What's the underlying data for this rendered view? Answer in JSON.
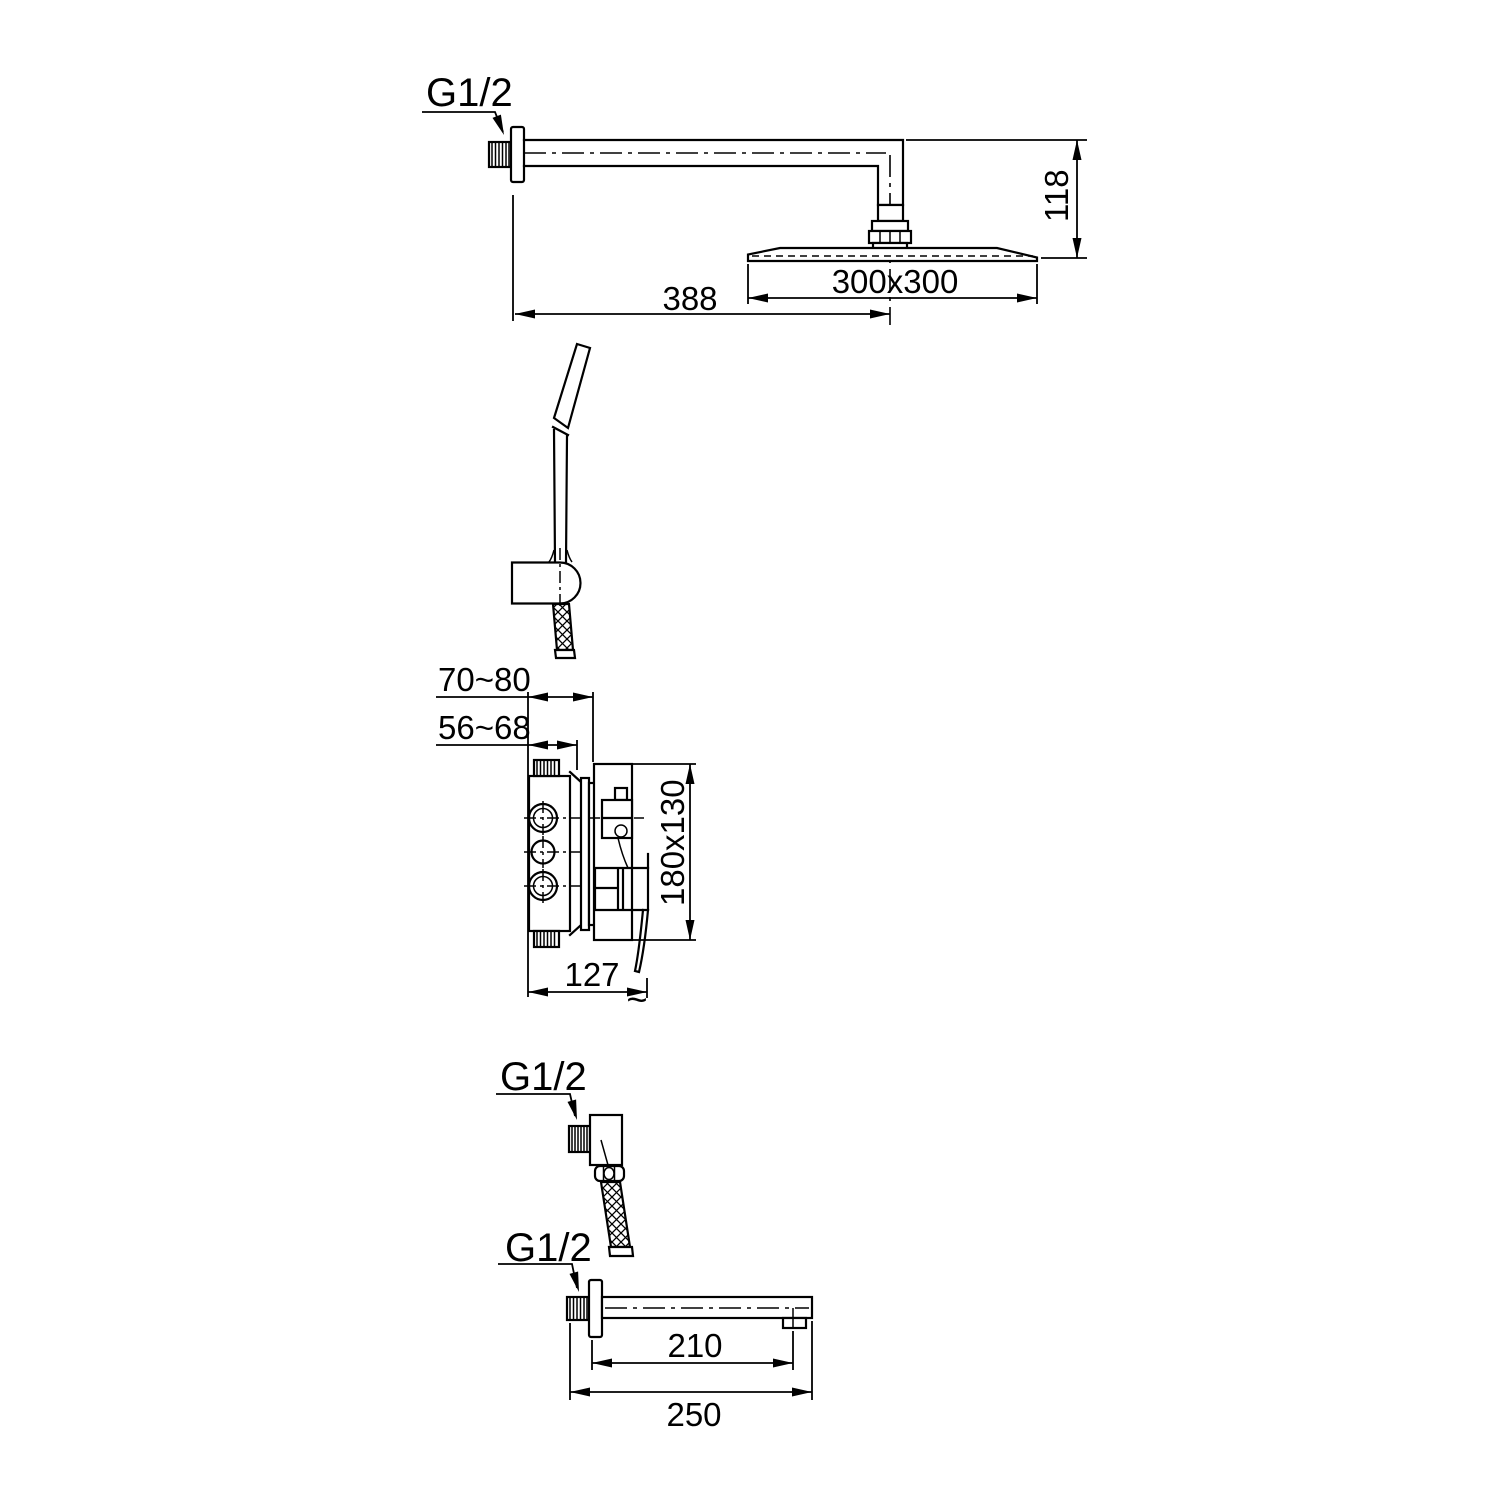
{
  "drawing": {
    "background_color": "#ffffff",
    "line_color": "#000000",
    "rain_shower": {
      "thread_label": "G1/2",
      "drop_height": "118",
      "head_size": "300x300",
      "arm_length": "388"
    },
    "mixer_valve": {
      "rough_in_depth_max": "70~80",
      "rough_in_depth_min": "56~68",
      "plate_size": "180x130",
      "handle_reach": "127",
      "approx_symbol": "~"
    },
    "wall_elbow": {
      "thread_label": "G1/2"
    },
    "bath_spout": {
      "thread_label": "G1/2",
      "spout_reach": "210",
      "total_length": "250"
    }
  }
}
